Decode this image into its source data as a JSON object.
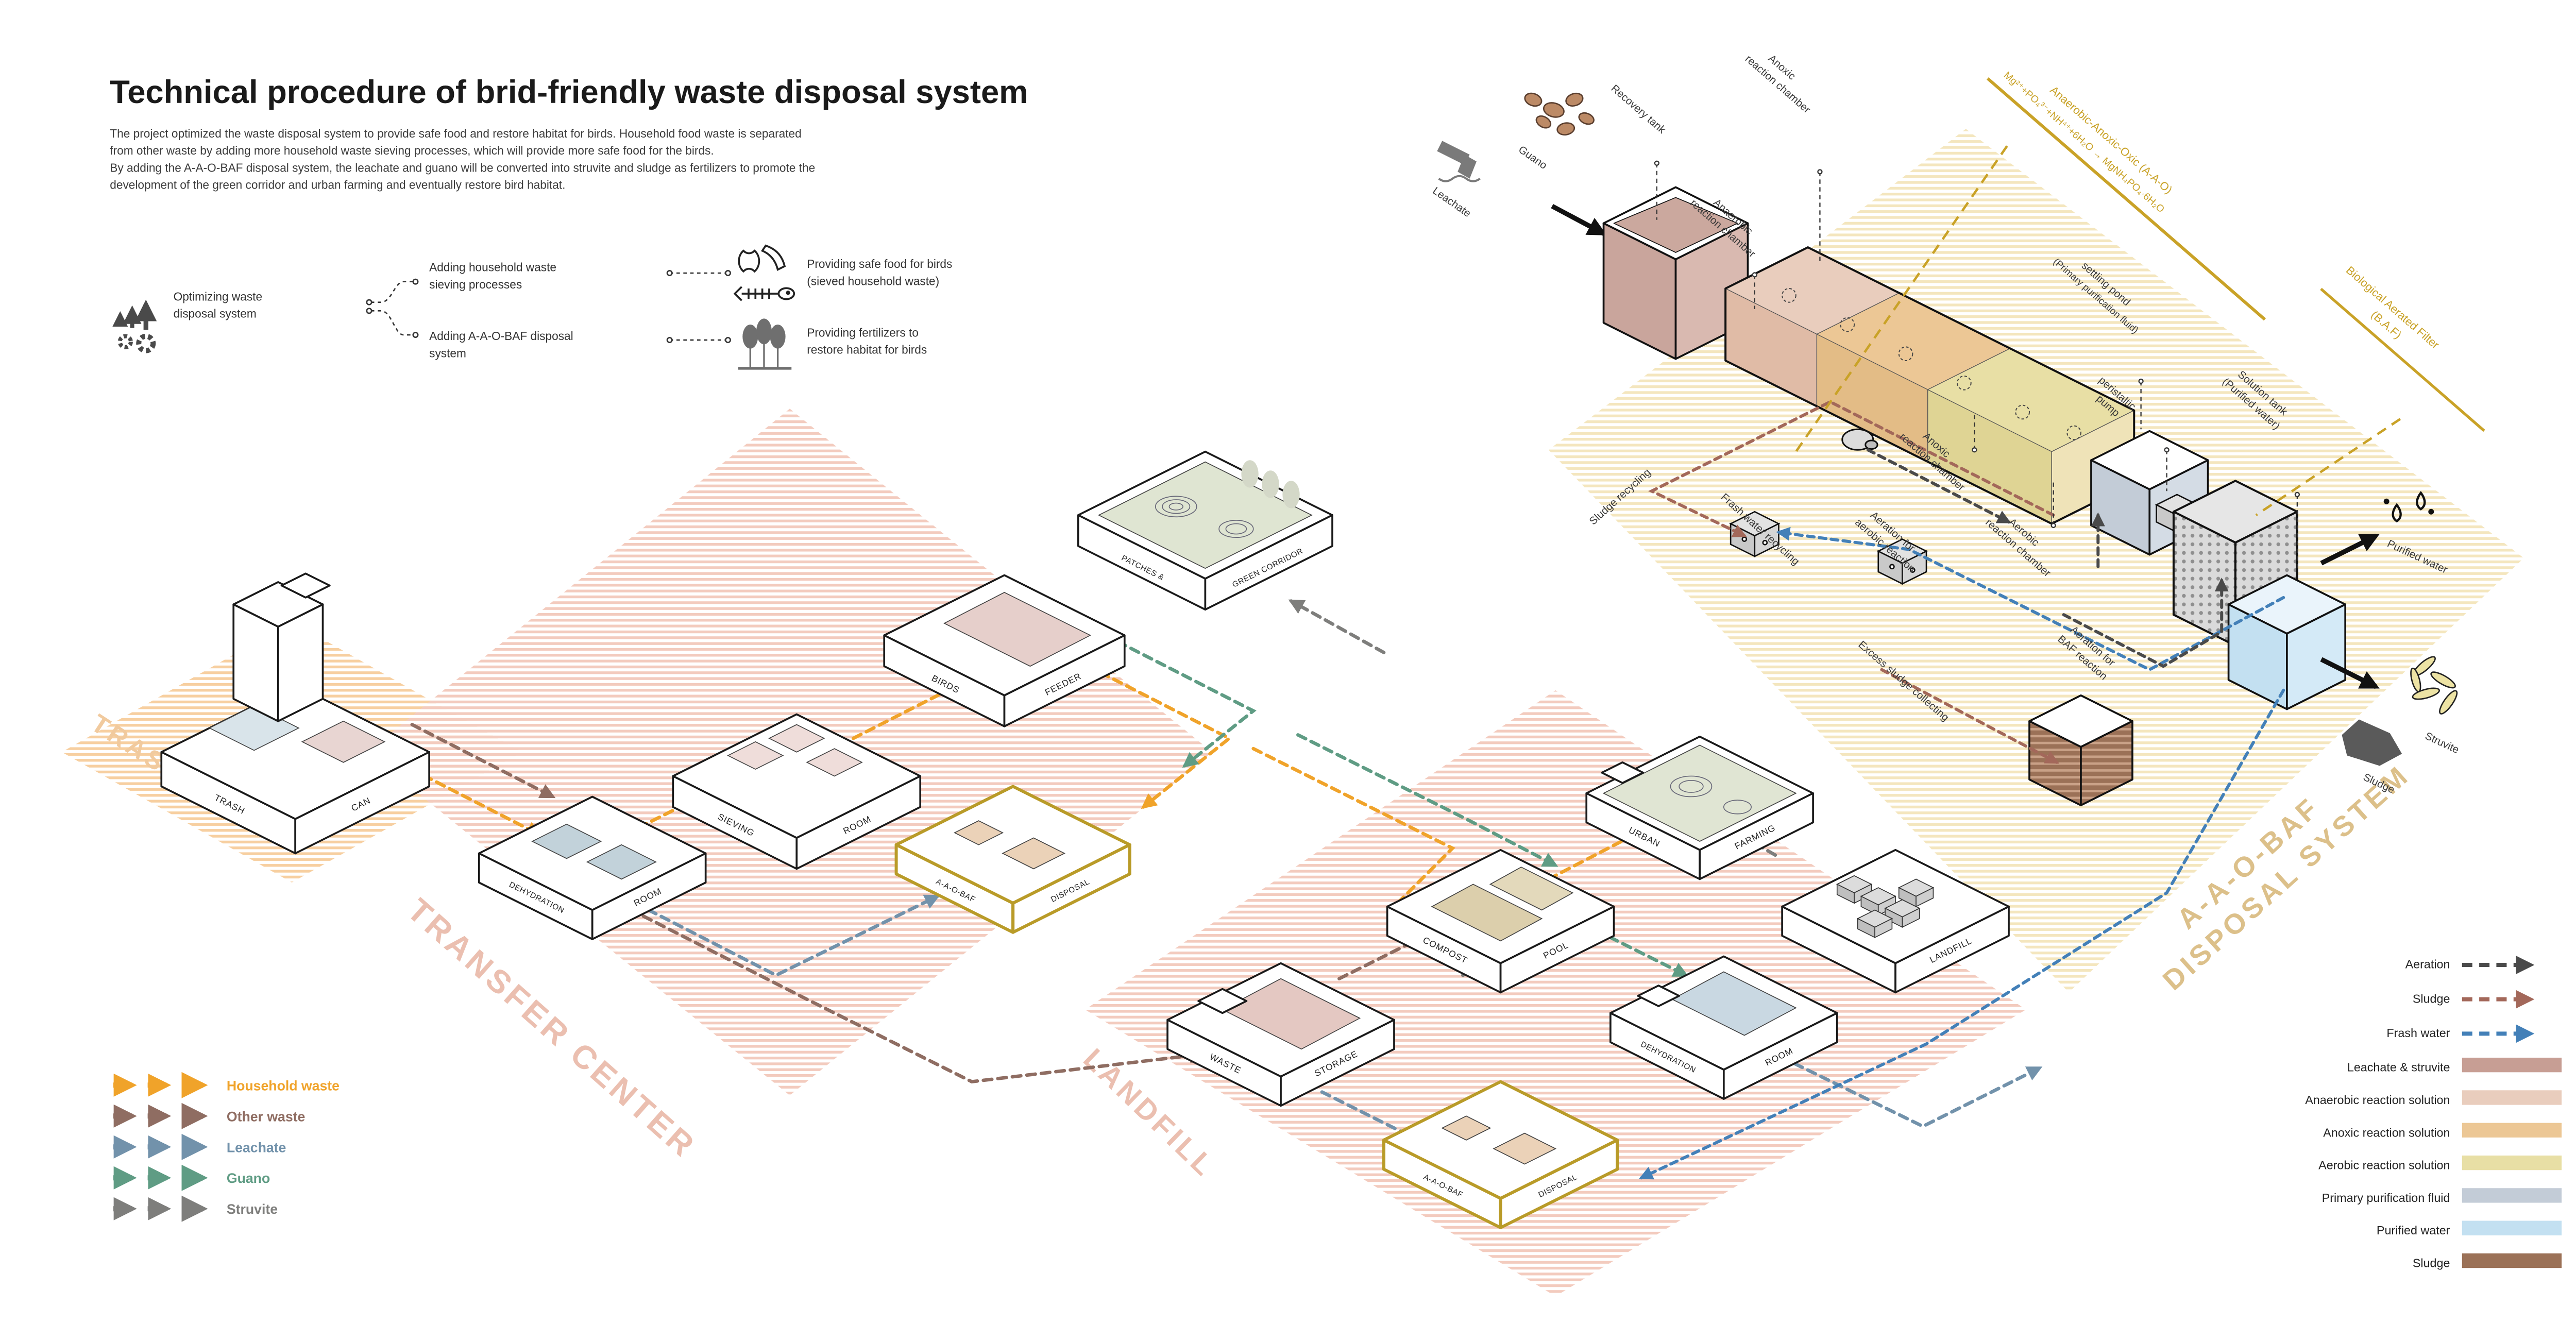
{
  "title": "Technical procedure of brid-friendly waste disposal system",
  "intro": {
    "l1": "The project optimized the waste disposal system to provide safe food and restore habitat for birds. Household food waste is separated",
    "l2": "from other waste by adding more household waste sieving processes, which will provide more safe food for the birds.",
    "l3": "By adding the A-A-O-BAF disposal system, the leachate and guano will be converted into struvite and sludge as fertilizers to promote the",
    "l4": "development of the green corridor and urban farming and eventually restore bird habitat."
  },
  "flow_legend": {
    "root_l1": "Optimizing waste",
    "root_l2": "disposal system",
    "b1_l1": "Adding household waste",
    "b1_l2": "sieving processes",
    "b2_l1": "Adding A-A-O-BAF disposal",
    "b2_l2": "system",
    "o1_l1": "Providing safe food for birds",
    "o1_l2": "(sieved household waste)",
    "o2_l1": "Providing fertilizers to",
    "o2_l2": "restore habitat for birds"
  },
  "zones": {
    "trash": "TRASH CAN",
    "transfer": "TRANSFER CENTER",
    "landfill": "LANDFILL",
    "aao_l1": "A-A-O-BAF",
    "aao_l2": "DISPOSAL SYSTEM"
  },
  "buildings": {
    "trash_l": "TRASH",
    "trash_r": "CAN",
    "dehydration_l": "DEHYDRATION",
    "dehydration_r": "ROOM",
    "sieving_l": "SIEVING",
    "sieving_r": "ROOM",
    "birds_l": "BIRDS",
    "birds_r": "FEEDER",
    "patches_l": "PATCHES &",
    "patches_r": "GREEN CORRIDOR",
    "aaobaf_l": "A-A-O-BAF",
    "aaobaf_r": "DISPOSAL",
    "waste_l": "WASTE",
    "waste_r": "STORAGE",
    "compost_l": "COMPOST",
    "compost_r": "POOL",
    "urban_l": "URBAN",
    "urban_r": "FARMING",
    "dehydration2_l": "DEHYDRATION",
    "dehydration2_r": "ROOM",
    "landfill_r": "LANDFILL",
    "aaobaf2_l": "A-A-O-BAF",
    "aaobaf2_r": "DISPOSAL"
  },
  "system": {
    "guano": "Guano",
    "leachate": "Leachate",
    "recovery": "Recovery tank",
    "anoxic1_l1": "Anoxic",
    "anoxic1_l2": "reaction chamber",
    "anaerobic_l1": "Anaerobic",
    "anaerobic_l2": "reaction chamber",
    "anoxic2_l1": "Anoxic",
    "anoxic2_l2": "reaction chamber",
    "aerobic_l1": "Aerobic",
    "aerobic_l2": "reaction chamber",
    "settling_l1": "settling pond",
    "settling_l2": "(Primary purification fluid)",
    "pump_l1": "peristaltic",
    "pump_l2": "pump",
    "solution_l1": "Solution tank",
    "solution_l2": "(Purified water)",
    "aao_title": "Anaerobic-Anoxic-Oxic (A-A-O)",
    "aao_formula": "Mg²⁺+PO₄³⁻+NH⁴⁺+6H₂O → MgNH₄PO₄·6H₂O",
    "baf_l1": "Biological Aerated Filter",
    "baf_l2": "(B.A.F)",
    "sludge_recycling": "Sludge recycling",
    "frash_recycling": "Frash water recycling",
    "aeration_aerobic_l1": "Aeration for",
    "aeration_aerobic_l2": "aerobic reaction",
    "aeration_baf_l1": "Aeration for",
    "aeration_baf_l2": "BAF reaction",
    "excess": "Excess sludge collecting",
    "purified": "Purified water",
    "struvite": "Struvite",
    "sludge": "Sludge"
  },
  "left_legend": {
    "items": [
      {
        "label": "Household waste",
        "color": "#F0A32A"
      },
      {
        "label": "Other waste",
        "color": "#8F6D62"
      },
      {
        "label": "Leachate",
        "color": "#7292AB"
      },
      {
        "label": "Guano",
        "color": "#5F9C84"
      },
      {
        "label": "Struvite",
        "color": "#7E7E7C"
      }
    ]
  },
  "right_legend": {
    "arrows": [
      {
        "label": "Aeration",
        "color": "#4A4A4A"
      },
      {
        "label": "Sludge",
        "color": "#A3685A"
      },
      {
        "label": "Frash water",
        "color": "#4380B8"
      }
    ],
    "swatches": [
      {
        "label": "Leachate & struvite",
        "color": "#C79E94"
      },
      {
        "label": "Anaerobic reaction solution",
        "color": "#E9CDBD"
      },
      {
        "label": "Anoxic reaction solution",
        "color": "#ECC795"
      },
      {
        "label": "Aerobic reaction solution",
        "color": "#E8DFA5"
      },
      {
        "label": "Primary purification fluid",
        "color": "#C3CCD7"
      },
      {
        "label": "Purified water",
        "color": "#C3E0F1"
      },
      {
        "label": "Sludge",
        "color": "#9B7157"
      }
    ]
  },
  "icons": {
    "optimize": "up-arrows-and-gears",
    "food": "food-scraps-apple-banana-fishbone",
    "trees": "three-trees",
    "leachate": "drain-pipe",
    "guano": "droppings",
    "purified": "water-drops",
    "struvite": "crystals",
    "sludge": "sludge-blob"
  }
}
